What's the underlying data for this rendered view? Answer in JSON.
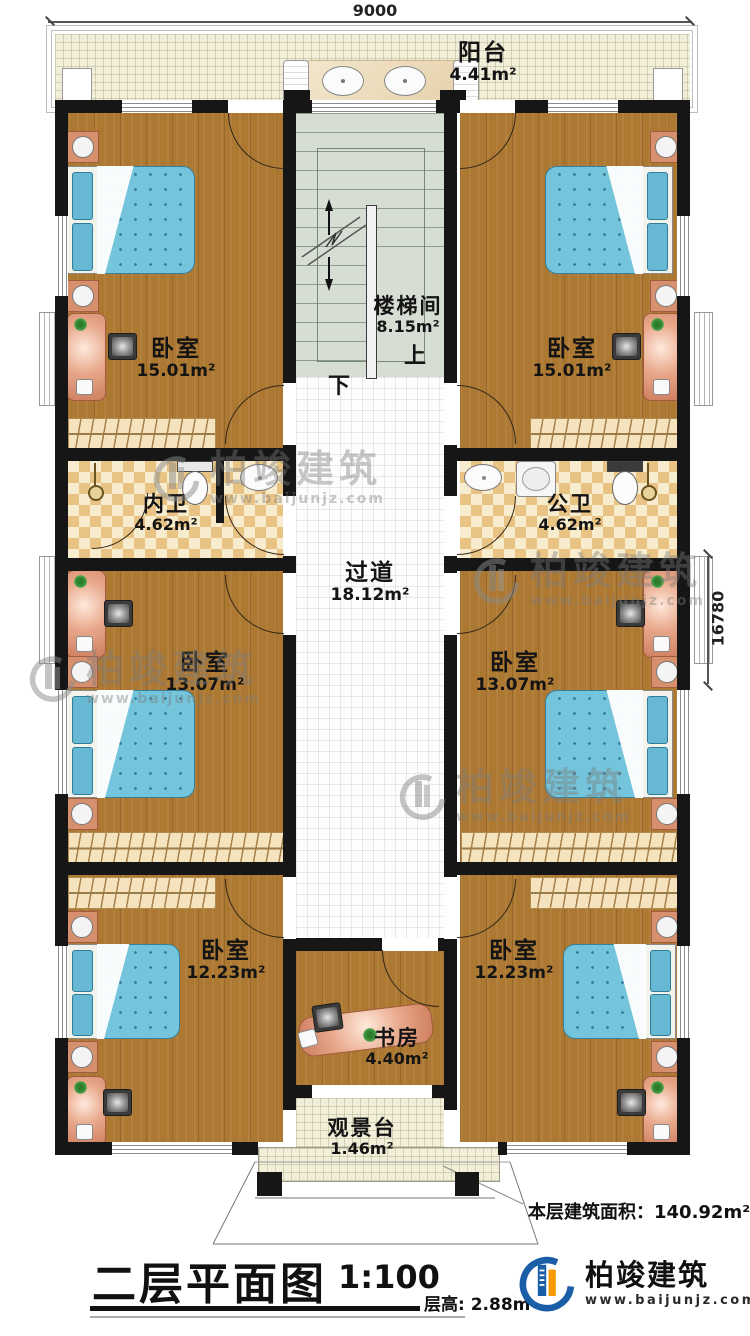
{
  "title_block": {
    "title": "二层平面图",
    "scale": "1:100",
    "floor_height": "层高: 2.88m"
  },
  "area_note": {
    "label": "本层建筑面积：",
    "value": "140.92m²"
  },
  "dimensions": {
    "top": "9000",
    "right": "16780"
  },
  "brand": {
    "name": "柏竣建筑",
    "url": "www.baijunjz.com"
  },
  "stairs": {
    "up": "上",
    "down": "下"
  },
  "rooms": {
    "balcony": {
      "name": "阳台",
      "area": "4.41m²"
    },
    "bedroom_tl": {
      "name": "卧室",
      "area": "15.01m²"
    },
    "bedroom_tr": {
      "name": "卧室",
      "area": "15.01m²"
    },
    "stairwell": {
      "name": "楼梯间",
      "area": "8.15m²"
    },
    "bath_inner": {
      "name": "内卫",
      "area": "4.62m²"
    },
    "bath_public": {
      "name": "公卫",
      "area": "4.62m²"
    },
    "corridor": {
      "name": "过道",
      "area": "18.12m²"
    },
    "bedroom_ml": {
      "name": "卧室",
      "area": "13.07m²"
    },
    "bedroom_mr": {
      "name": "卧室",
      "area": "13.07m²"
    },
    "bedroom_bl": {
      "name": "卧室",
      "area": "12.23m²"
    },
    "bedroom_br": {
      "name": "卧室",
      "area": "12.23m²"
    },
    "study": {
      "name": "书房",
      "area": "4.40m²"
    },
    "view_deck": {
      "name": "观景台",
      "area": "1.46m²"
    }
  },
  "colors": {
    "wall": "#161616",
    "wood_floor": "#ac7832",
    "bed_quilt": "#74c4db",
    "bath_tile": "#e9c383",
    "stair": "#d6ded4",
    "balcony_tile": "#f1eeda",
    "logo_blue": "#1b5ea8",
    "logo_orange": "#f59a00"
  }
}
